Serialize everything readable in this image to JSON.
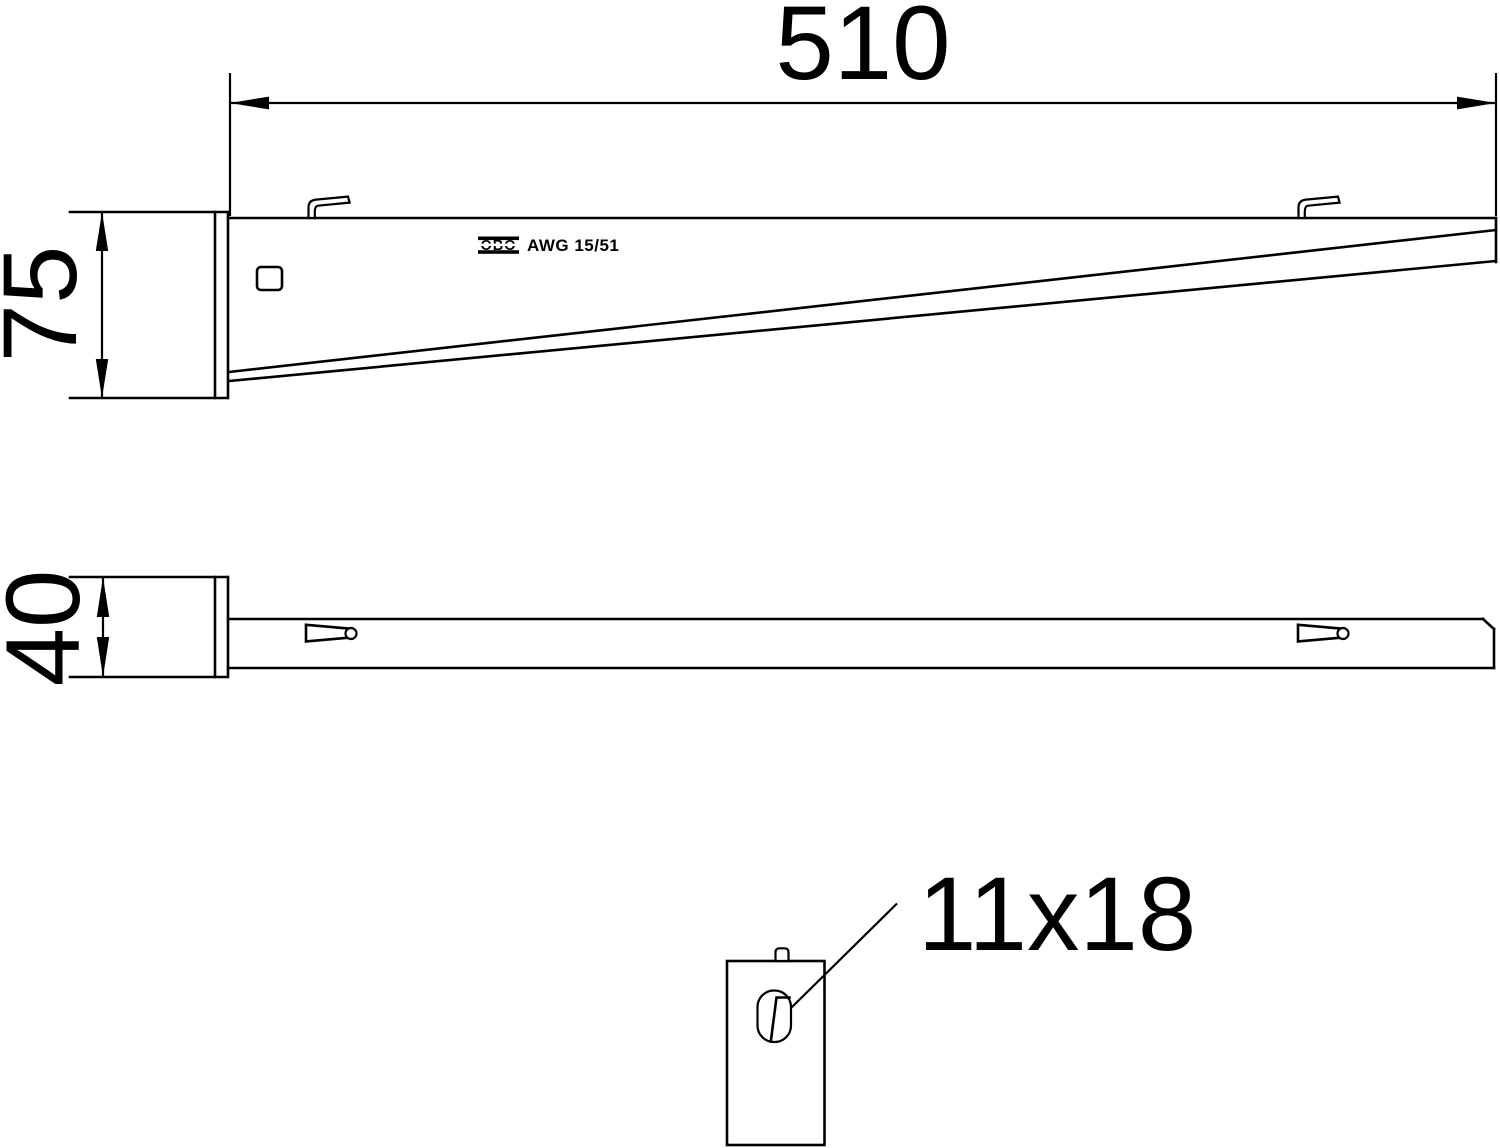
{
  "drawing": {
    "type": "technical-drawing",
    "brand": "OBO",
    "product_code": "AWG 15/51",
    "callouts": {
      "length": "510",
      "height": "75",
      "width": "40",
      "slot": "11x18"
    },
    "colors": {
      "line": "#000000",
      "background": "#ffffff"
    }
  }
}
